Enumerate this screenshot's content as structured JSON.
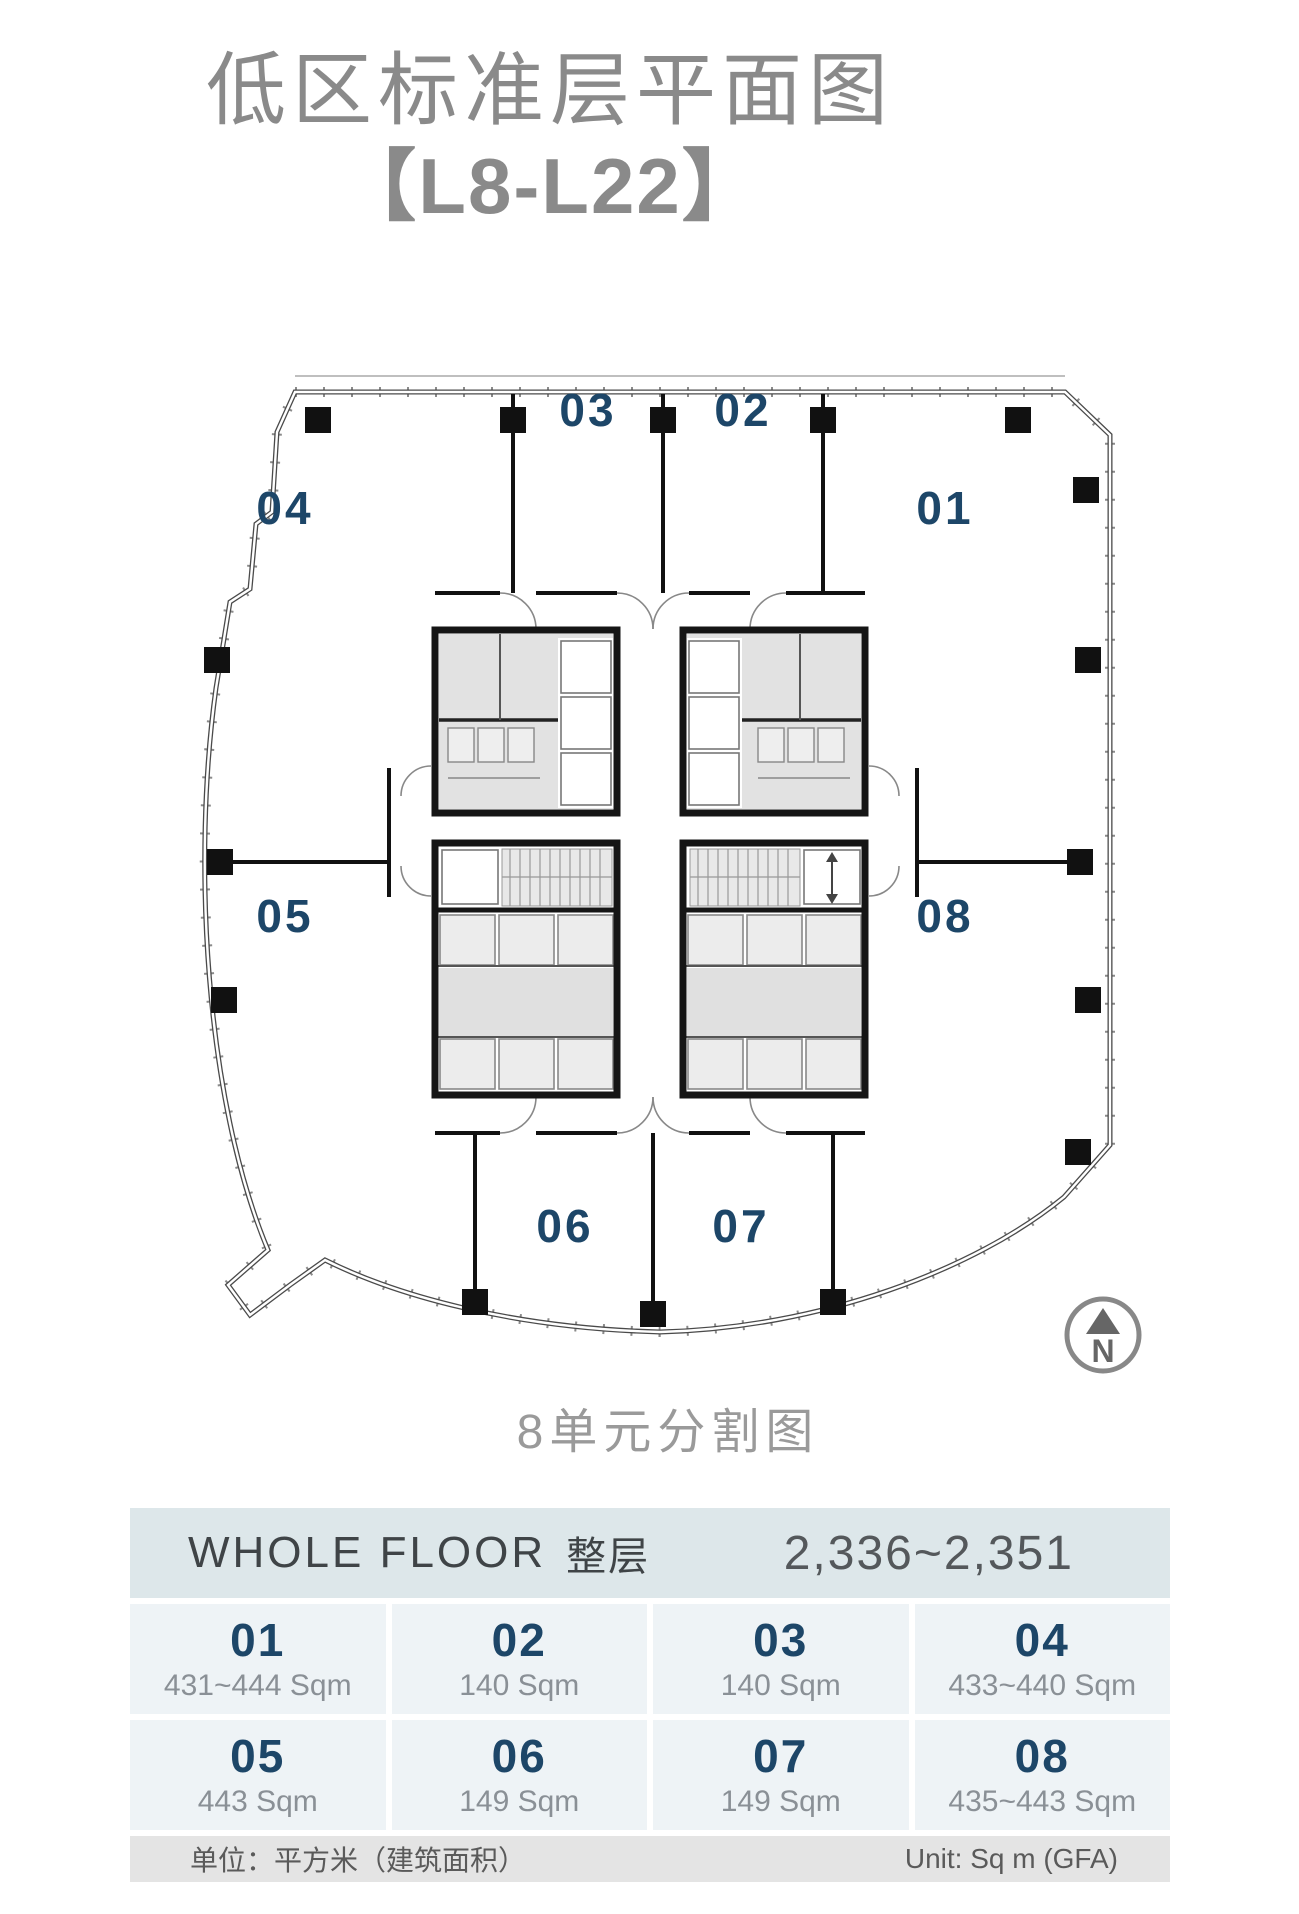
{
  "header": {
    "title": "低区标准层平面图",
    "subtitle": "【L8-L22】"
  },
  "plan": {
    "units": [
      "01",
      "02",
      "03",
      "04",
      "05",
      "06",
      "07",
      "08"
    ],
    "caption": "8单元分割图",
    "compass_letter": "N"
  },
  "table": {
    "whole_floor_en": "WHOLE FLOOR",
    "whole_floor_zh": "整层",
    "whole_floor_range": "2,336~2,351",
    "units": [
      {
        "no": "01",
        "area": "431~444 Sqm"
      },
      {
        "no": "02",
        "area": "140 Sqm"
      },
      {
        "no": "03",
        "area": "140 Sqm"
      },
      {
        "no": "04",
        "area": "433~440 Sqm"
      },
      {
        "no": "05",
        "area": "443 Sqm"
      },
      {
        "no": "06",
        "area": "149 Sqm"
      },
      {
        "no": "07",
        "area": "149 Sqm"
      },
      {
        "no": "08",
        "area": "435~443 Sqm"
      }
    ],
    "footer_left": "单位：平方米（建筑面积）",
    "footer_right": "Unit: Sq m (GFA)"
  },
  "colors": {
    "unit_label": "#1d4668",
    "title_gray": "#8a8a8a",
    "table_header_bg": "#dde7ea",
    "table_cell_bg": "#eef3f6",
    "table_footer_bg": "#e4e4e4",
    "wall_black": "#1a1a1a",
    "core_gray": "#e2e2e2"
  }
}
